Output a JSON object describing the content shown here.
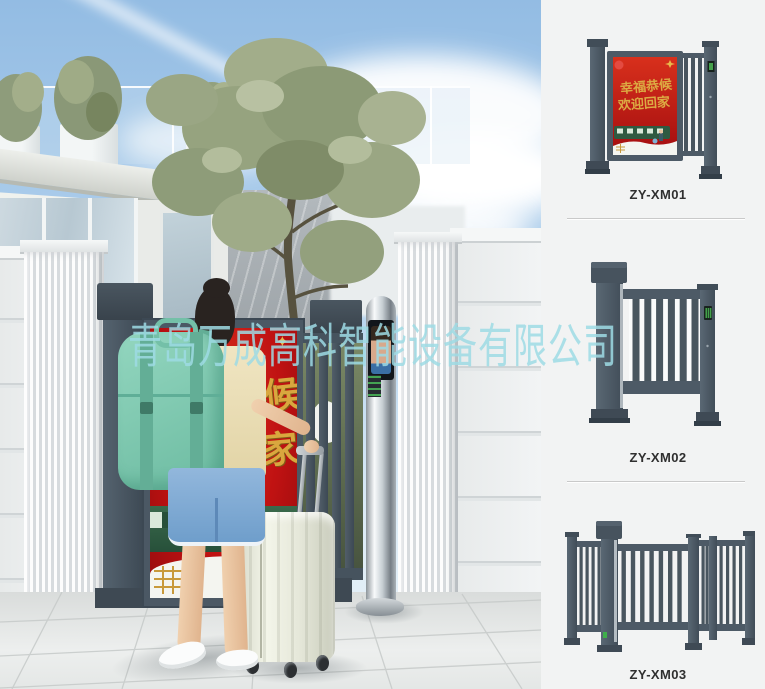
{
  "watermark": {
    "text": "青岛万成高科智能设备有限公司",
    "color": "#9fdbe4"
  },
  "photo": {
    "poster": {
      "line1": "幸福恭候",
      "line2": "欢迎回家"
    },
    "shirt_print": "ゴ三川"
  },
  "products": [
    {
      "label": "ZY-XM01"
    },
    {
      "label": "ZY-XM02"
    },
    {
      "label": "ZY-XM03"
    }
  ],
  "colors": {
    "gate_frame": "#4b5864",
    "poster_red": "#c01414",
    "poster_gold": "#d9a73e",
    "panel_background": "#f2f3f3",
    "backpack_teal": "#7fcbb2",
    "sky_blue": "#9cc1e5",
    "watermark_cyan": "#9fdbe4"
  }
}
